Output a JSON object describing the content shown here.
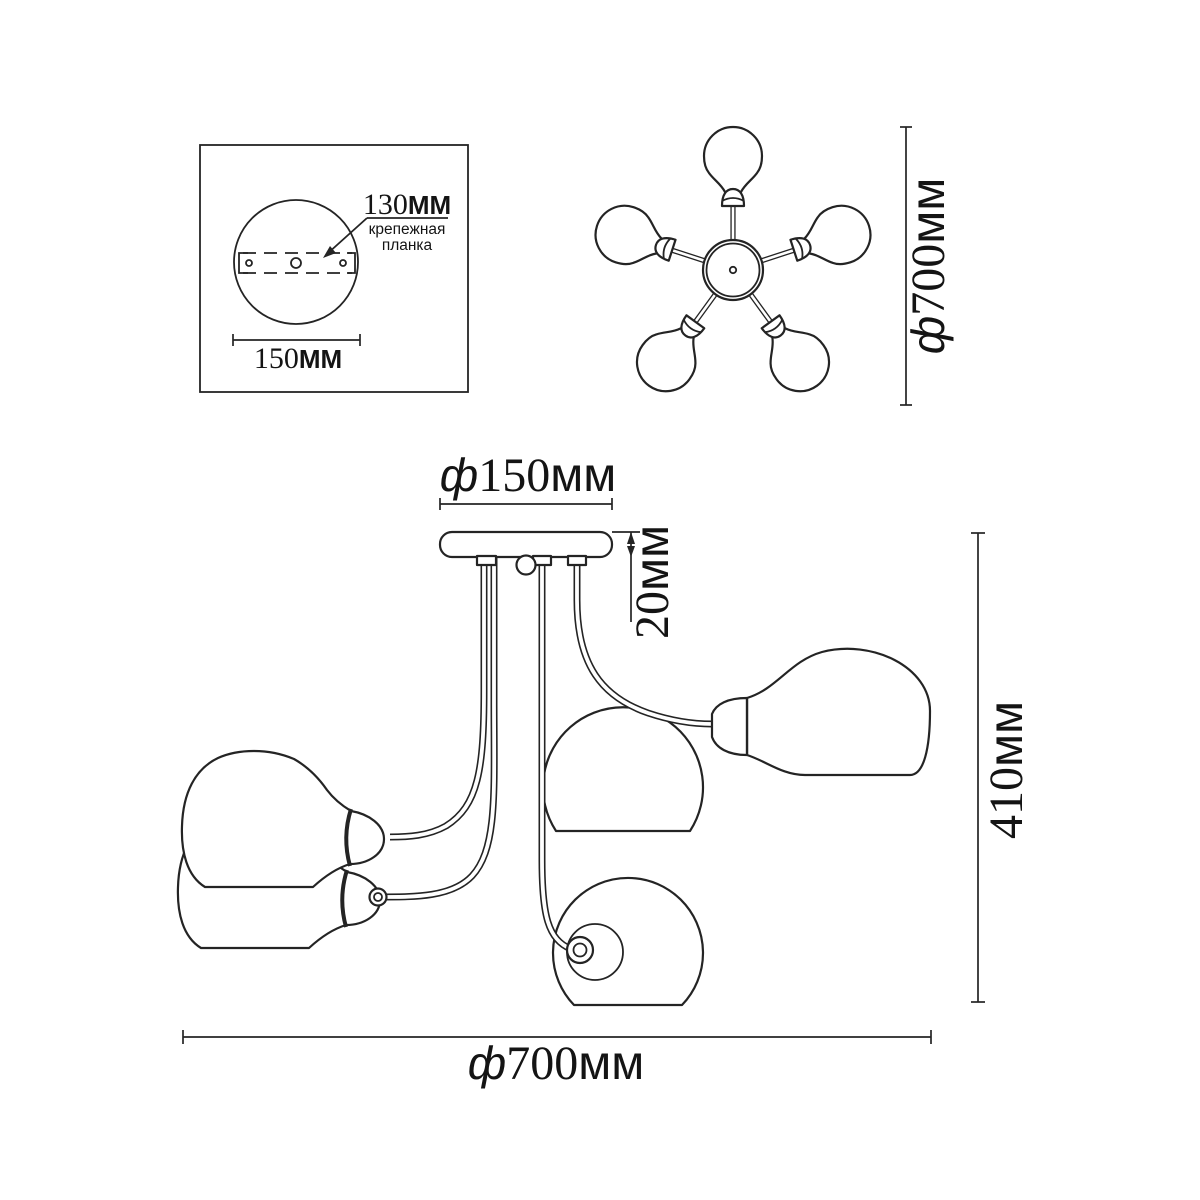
{
  "diagram": {
    "detail_box": {
      "bracket_dim": {
        "value": "130",
        "unit": "ММ"
      },
      "bracket_caption_line1": "крепежная",
      "bracket_caption_line2": "планка",
      "base_dim": {
        "value": "150",
        "unit": "ММ"
      }
    },
    "top_view": {
      "diameter_dim": {
        "prefix": "ф",
        "value": "700",
        "unit": "мм"
      }
    },
    "side_view": {
      "canopy_diameter_dim": {
        "prefix": "ф",
        "value": "150",
        "unit": "мм"
      },
      "canopy_height_dim": {
        "value": "20",
        "unit": "мм"
      },
      "overall_height_dim": {
        "value": "410",
        "unit": "мм"
      },
      "overall_diameter_dim": {
        "prefix": "ф",
        "value": "700",
        "unit": "мм"
      }
    },
    "colors": {
      "line": "#242424",
      "background": "#ffffff"
    }
  }
}
